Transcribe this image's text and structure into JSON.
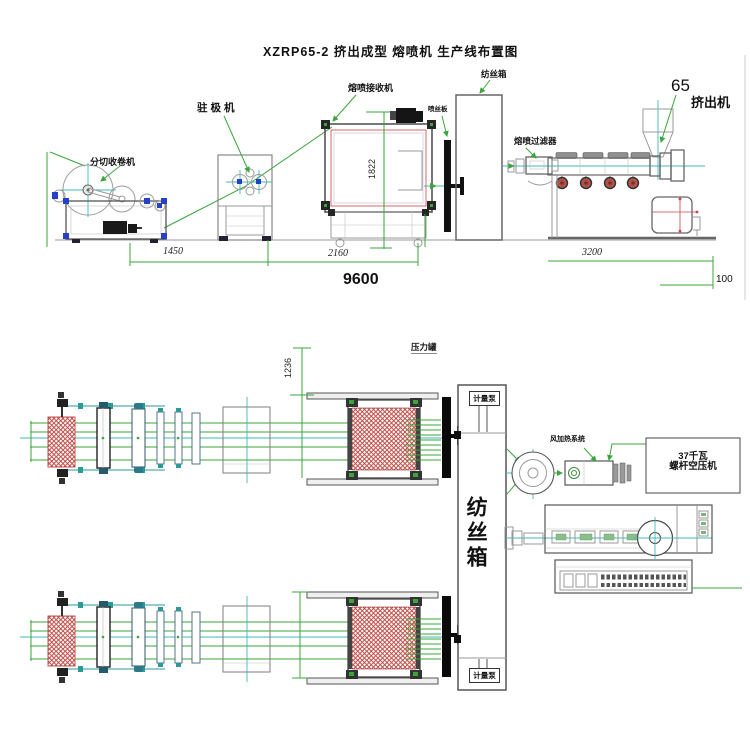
{
  "title": "XZRP65-2 挤出成型 熔喷机 生产线布置图",
  "elevation": {
    "labels": {
      "slitter_winder": "分切收卷机",
      "electret_machine": "驻极机",
      "meltblown_receiver": "熔喷接收机",
      "spinneret_plate": "喷丝板",
      "spinning_box": "纺丝箱",
      "meltblown_filter": "熔喷过滤器",
      "extruder_size": "65",
      "extruder": "挤出机"
    },
    "dims": {
      "winder_gap": "1450",
      "receiver_gap": "2160",
      "receiver_height": "1822",
      "extruder_length": "3200",
      "total_length": "9600",
      "end_clearance": "100"
    }
  },
  "plan": {
    "labels": {
      "pressure_tank": "压力罐",
      "metering_pump_top": "计量泵",
      "metering_pump_bottom": "计量泵",
      "spinning_box": "纺丝箱",
      "air_heating_system": "风加热系统",
      "compressor_line1": "37千瓦",
      "compressor_line2": "螺杆空压机"
    },
    "dims": {
      "box_offset": "1236"
    }
  },
  "colors": {
    "line_gray": "#9a9a9a",
    "accent_green": "#3aa53a",
    "center_cyan": "#3fb9b9",
    "frame_blue": "#2740c8",
    "hatch_red": "#c4504a",
    "heater_red": "#b0524a"
  }
}
